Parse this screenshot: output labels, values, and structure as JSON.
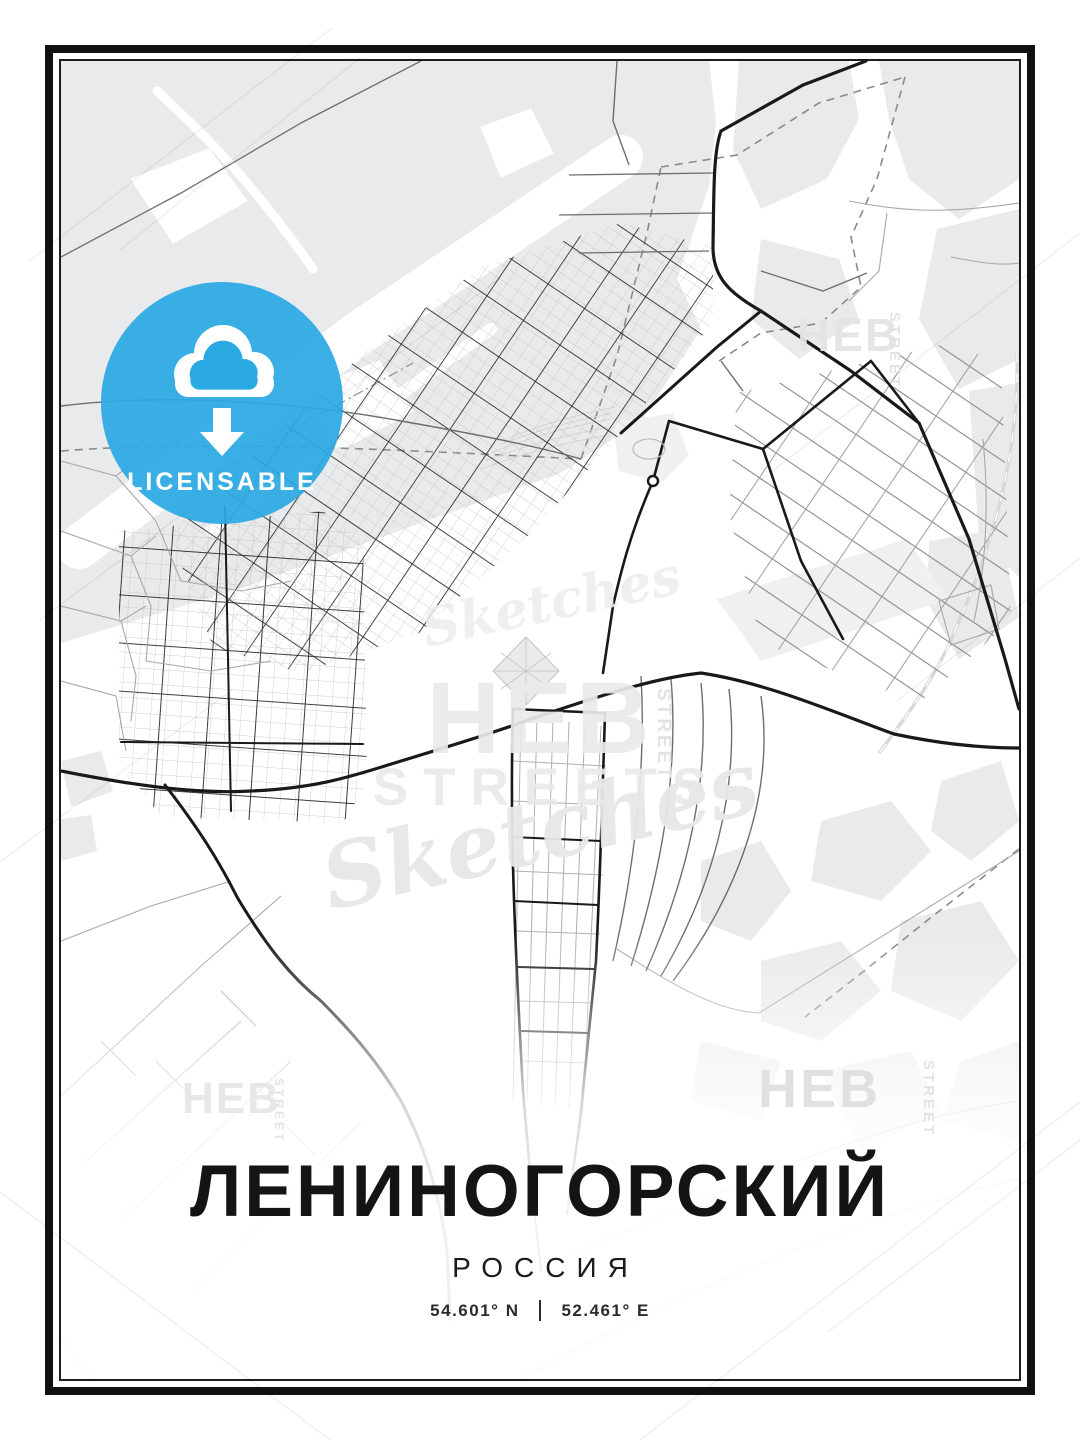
{
  "poster": {
    "title": "ЛЕНИНОГОРСКИЙ",
    "subtitle": "РОССИЯ",
    "latitude": "54.601° N",
    "separator": "|",
    "longitude": "52.461° E"
  },
  "badge": {
    "label": "LICENSABLE",
    "icon": "cloud-download-icon",
    "color": "#2BA9E3"
  },
  "watermark": {
    "brand": "HEB",
    "streets": "STREETS",
    "script": "Sketches",
    "vertical": "STREET"
  },
  "map": {
    "colors": {
      "background": "#ffffff",
      "landcover": "#e9eaec",
      "landcover_light": "#eff0f2",
      "road_minor": "#a8a8a8",
      "road_medium": "#6e6e6e",
      "road_major": "#191919",
      "boundary_dash": "#8a8a8a",
      "railway": "#d8d8d8",
      "frame": "#111111"
    }
  }
}
